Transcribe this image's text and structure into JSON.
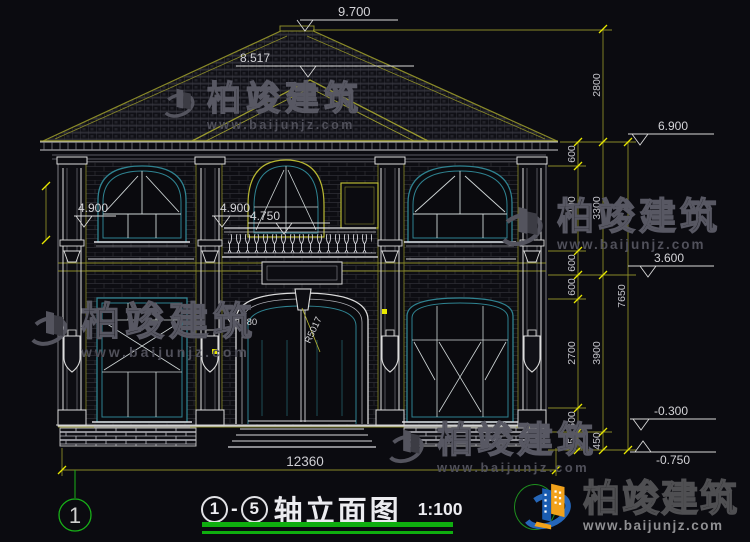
{
  "drawing": {
    "levels": {
      "ridge": "9.700",
      "pediment": "8.517",
      "eave": "6.900",
      "left_window": "4.900",
      "center_window": "4.900",
      "center_balcony": "4.750",
      "second_floor": "3.600",
      "ground_out": "-0.300",
      "foundation": "-0.750"
    },
    "dims": {
      "chain_inner": [
        "600",
        "2100",
        "600",
        "600",
        "2700",
        "600",
        "450"
      ],
      "chain_mid": [
        "2800",
        "3300",
        "3900",
        "450"
      ],
      "chain_total": "7650",
      "bottom_total": "12360",
      "door_arc_radius": "R5017",
      "door_note": "1980"
    },
    "axis": {
      "left": "1"
    }
  },
  "watermark": {
    "name": "柏竣建筑",
    "url": "www.baijunjz.com"
  },
  "title_block": {
    "axis_start": "1",
    "separator": "-",
    "axis_end": "5",
    "title": "轴立面图",
    "scale": "1:100"
  },
  "brand": {
    "name": "柏竣建筑",
    "url": "www.baijunjz.com"
  }
}
